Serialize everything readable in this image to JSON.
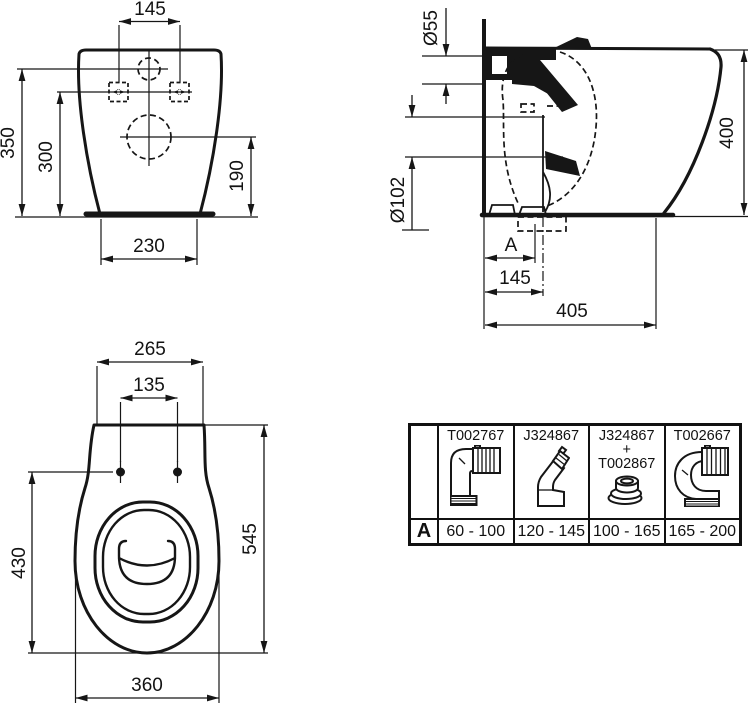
{
  "colors": {
    "ink": "#161616",
    "background": "#ffffff"
  },
  "views": {
    "front": {
      "hole_spacing": "145",
      "overall_height": "350",
      "fixing_height": "300",
      "outlet_height": "190",
      "base_width": "230"
    },
    "side": {
      "inlet_diameter": "Ø55",
      "outlet_diameter": "Ø102",
      "overall_height": "400",
      "rough_in": "A",
      "outlet_offset": "145",
      "base_depth": "405"
    },
    "top": {
      "back_width": "265",
      "hinge_spacing": "135",
      "seat_length": "430",
      "overall_depth": "545",
      "bowl_width": "360"
    }
  },
  "table": {
    "row_label": "A",
    "columns": [
      {
        "code": "T002767",
        "range": "60 - 100",
        "icon": "elbow-connector"
      },
      {
        "code": "J324867",
        "range": "120 - 145",
        "icon": "angled-connector"
      },
      {
        "code": "J324867",
        "plus": "+",
        "code2": "T002867",
        "range": "100 - 165",
        "icon": "gasket-ring"
      },
      {
        "code": "T002667",
        "range": "165 - 200",
        "icon": "swan-neck-connector"
      }
    ]
  }
}
